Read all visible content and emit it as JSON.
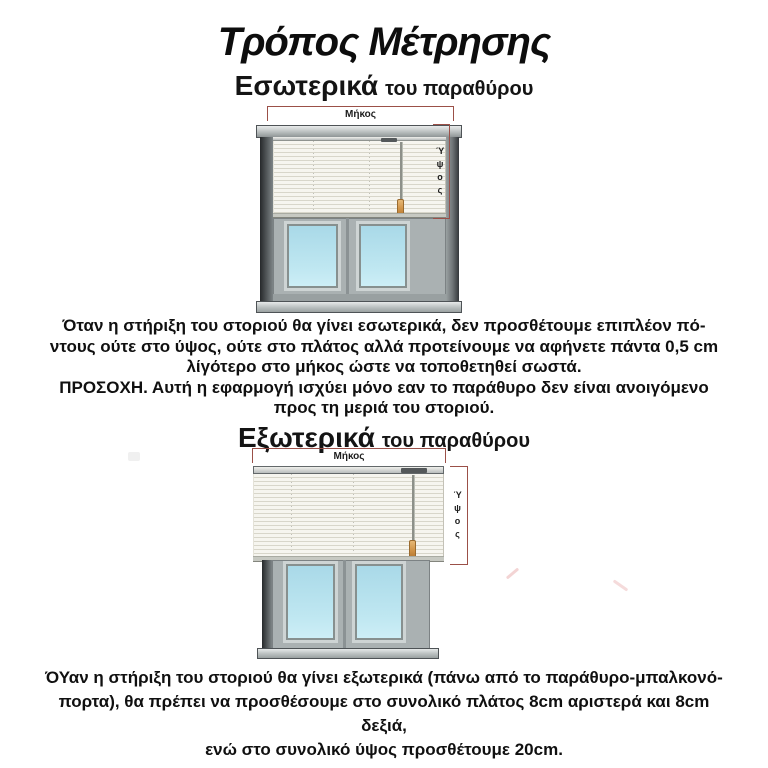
{
  "title": "Τρόπος Μέτρησης",
  "interior": {
    "heading": "Εσωτερικά",
    "heading_suffix": "του παραθύρου",
    "length_label": "Μήκος",
    "height_label": "Ύψος",
    "lines": [
      "Όταν η στήριξη του στοριού θα γίνει εσωτερικά, δεν προσθέτουμε επιπλέον πό-",
      "ντους ούτε στο ύψος, ούτε στο πλάτος αλλά προτείνουμε να αφήνετε πάντα 0,5 cm",
      "λίγότερο στο μήκος ώστε να τοποθετηθεί σωστά.",
      "ΠΡΟΣΟΧΗ. Αυτή η εφαρμογή ισχύει μόνο εαν το παράθυρο δεν είναι ανοιγόμενο",
      "προς τη μεριά του στοριού."
    ]
  },
  "exterior": {
    "heading": "Εξωτερικά",
    "heading_suffix": "του παραθύρου",
    "length_label": "Μήκος",
    "height_label": "Ύψος",
    "lines": [
      "ΌΥαν η στήριξη του στοριού θα γίνει εξωτερικά (πάνω από το παράθυρο-μπαλκονό-",
      "πορτα), θα πρέπει να προσθέσουμε στο συνολικό πλάτος 8cm αριστερά και 8cm δεξιά,",
      "ενώ στο συνολικό ύψος προσθέτουμε 20cm."
    ]
  },
  "colors": {
    "dimension_line": "#9b5048",
    "window_frame_gray": "#aab1b2",
    "glass_blue": "#b9e1ec",
    "blind_cream": "#f4f3ec",
    "tassel_orange": "#cf9246",
    "text_black": "#111111"
  }
}
